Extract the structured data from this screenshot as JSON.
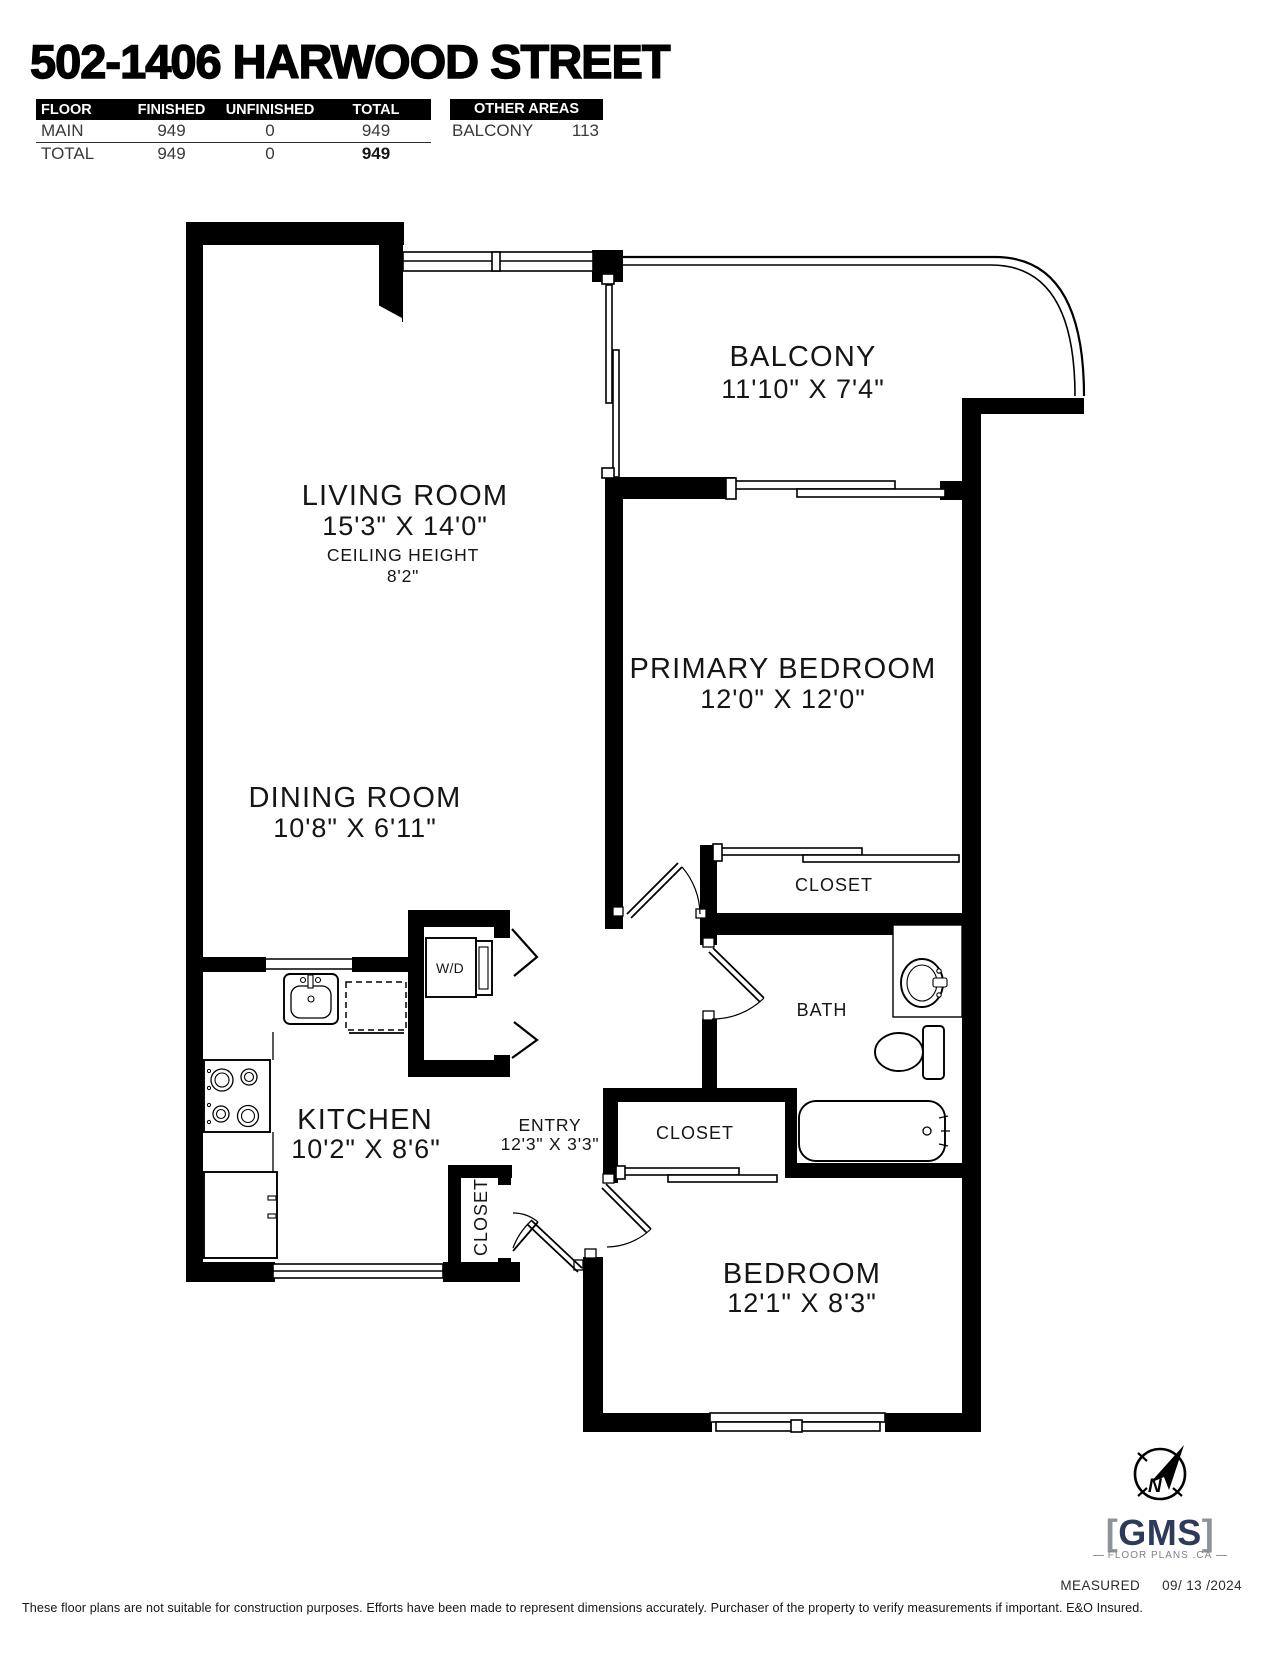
{
  "title": "502-1406 HARWOOD STREET",
  "area_table": {
    "headers": [
      "FLOOR",
      "FINISHED",
      "UNFINISHED",
      "TOTAL"
    ],
    "rows": [
      {
        "floor": "MAIN",
        "finished": "949",
        "unfinished": "0",
        "total": "949"
      },
      {
        "floor": "TOTAL",
        "finished": "949",
        "unfinished": "0",
        "total": "949"
      }
    ]
  },
  "other_areas": {
    "header": "OTHER AREAS",
    "name": "BALCONY",
    "value": "113"
  },
  "rooms": {
    "balcony": {
      "name": "BALCONY",
      "dims": "11'10\" X 7'4\""
    },
    "living": {
      "name": "LIVING ROOM",
      "dims": "15'3\" X 14'0\"",
      "ceiling_label": "CEILING HEIGHT",
      "ceiling": "8'2\""
    },
    "primary": {
      "name": "PRIMARY BEDROOM",
      "dims": "12'0\" X 12'0\""
    },
    "dining": {
      "name": "DINING ROOM",
      "dims": "10'8\" X 6'11\""
    },
    "kitchen": {
      "name": "KITCHEN",
      "dims": "10'2\" X 8'6\""
    },
    "entry": {
      "name": "ENTRY",
      "dims": "12'3\" X 3'3\""
    },
    "bath": {
      "name": "BATH"
    },
    "bedroom": {
      "name": "BEDROOM",
      "dims": "12'1\" X 8'3\""
    },
    "closet_primary": {
      "name": "CLOSET"
    },
    "closet_bedroom": {
      "name": "CLOSET"
    },
    "closet_entry": {
      "name": "CLOSET"
    },
    "wd": {
      "name": "W/D"
    }
  },
  "brand": {
    "bracket_open": "[",
    "gms": "GMS",
    "bracket_close": "]",
    "sub": "FLOOR PLANS .CA",
    "compass_n": "N"
  },
  "footer": {
    "measured_label": "MEASURED",
    "measured_date": "09/ 13 /2024",
    "disclaimer": "These floor plans are not suitable for construction purposes. Efforts have been made to represent dimensions accurately.  Purchaser of the property to verify measurements if important.  E&O Insured."
  }
}
